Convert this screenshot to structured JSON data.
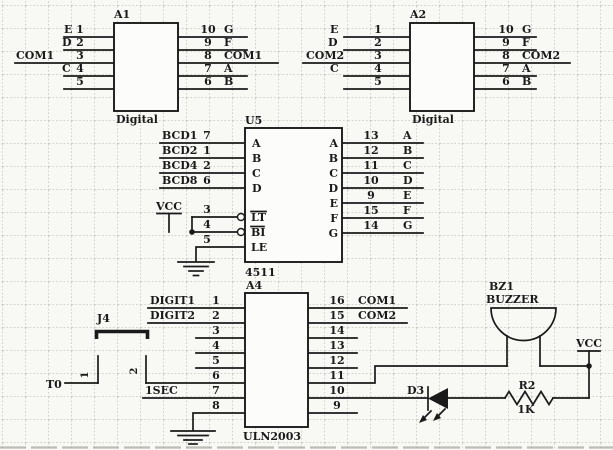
{
  "colors": {
    "ink": "#1a1a1a",
    "paper": "#f8f8f5",
    "grid": "#c3c6c2"
  },
  "components": {
    "a1": {
      "ref": "A1",
      "device": "Digital",
      "left": [
        {
          "name": "E",
          "num": "1"
        },
        {
          "name": "D",
          "num": "2"
        },
        {
          "name": "COM1",
          "num": "3"
        },
        {
          "name": "C",
          "num": "4"
        },
        {
          "num": "5"
        }
      ],
      "right": [
        {
          "num": "10",
          "name": "G"
        },
        {
          "num": "9",
          "name": "F"
        },
        {
          "num": "8",
          "name": "COM1"
        },
        {
          "num": "7",
          "name": "A"
        },
        {
          "num": "6",
          "name": "B"
        }
      ]
    },
    "a2": {
      "ref": "A2",
      "device": "Digital",
      "left": [
        {
          "name": "E",
          "num": "1"
        },
        {
          "name": "D",
          "num": "2"
        },
        {
          "name": "COM2",
          "num": "3"
        },
        {
          "name": "C",
          "num": "4"
        },
        {
          "num": "5"
        }
      ],
      "right": [
        {
          "num": "10",
          "name": "G"
        },
        {
          "num": "9",
          "name": "F"
        },
        {
          "num": "8",
          "name": "COM2"
        },
        {
          "num": "7",
          "name": "A"
        },
        {
          "num": "6",
          "name": "B"
        }
      ]
    },
    "u5": {
      "ref": "U5",
      "device": "4511",
      "vcc_label": "VCC",
      "inputs": [
        {
          "net": "BCD1",
          "num": "7",
          "port": "A"
        },
        {
          "net": "BCD2",
          "num": "1",
          "port": "B"
        },
        {
          "net": "BCD4",
          "num": "2",
          "port": "C"
        },
        {
          "net": "BCD8",
          "num": "6",
          "port": "D"
        }
      ],
      "controls": [
        {
          "num": "3",
          "port": "LT"
        },
        {
          "num": "4",
          "port": "BI"
        },
        {
          "num": "5",
          "port": "LE"
        }
      ],
      "outputs": [
        {
          "port": "A",
          "num": "13",
          "name": "A"
        },
        {
          "port": "B",
          "num": "12",
          "name": "B"
        },
        {
          "port": "C",
          "num": "11",
          "name": "C"
        },
        {
          "port": "D",
          "num": "10",
          "name": "D"
        },
        {
          "port": "E",
          "num": "9",
          "name": "E"
        },
        {
          "port": "F",
          "num": "15",
          "name": "F"
        },
        {
          "port": "G",
          "num": "14",
          "name": "G"
        }
      ]
    },
    "a4": {
      "ref": "A4",
      "device": "ULN2003",
      "left": [
        {
          "net": "DIGIT1",
          "num": "1"
        },
        {
          "net": "DIGIT2",
          "num": "2"
        },
        {
          "num": "3"
        },
        {
          "num": "4"
        },
        {
          "num": "5"
        },
        {
          "num": "6"
        },
        {
          "net": "1SEC",
          "num": "7"
        },
        {
          "num": "8"
        }
      ],
      "right": [
        {
          "num": "16",
          "net": "COM1"
        },
        {
          "num": "15",
          "net": "COM2"
        },
        {
          "num": "14"
        },
        {
          "num": "13"
        },
        {
          "num": "12"
        },
        {
          "num": "11"
        },
        {
          "num": "10"
        },
        {
          "num": "9"
        }
      ]
    },
    "j4": {
      "ref": "J4",
      "pin1": "1",
      "pin2": "2"
    },
    "bz1": {
      "ref": "BZ1",
      "device": "BUZZER"
    },
    "d3": {
      "ref": "D3"
    },
    "r2": {
      "ref": "R2",
      "value": "1K"
    },
    "nets": {
      "t0": "T0",
      "vcc": "VCC"
    }
  }
}
